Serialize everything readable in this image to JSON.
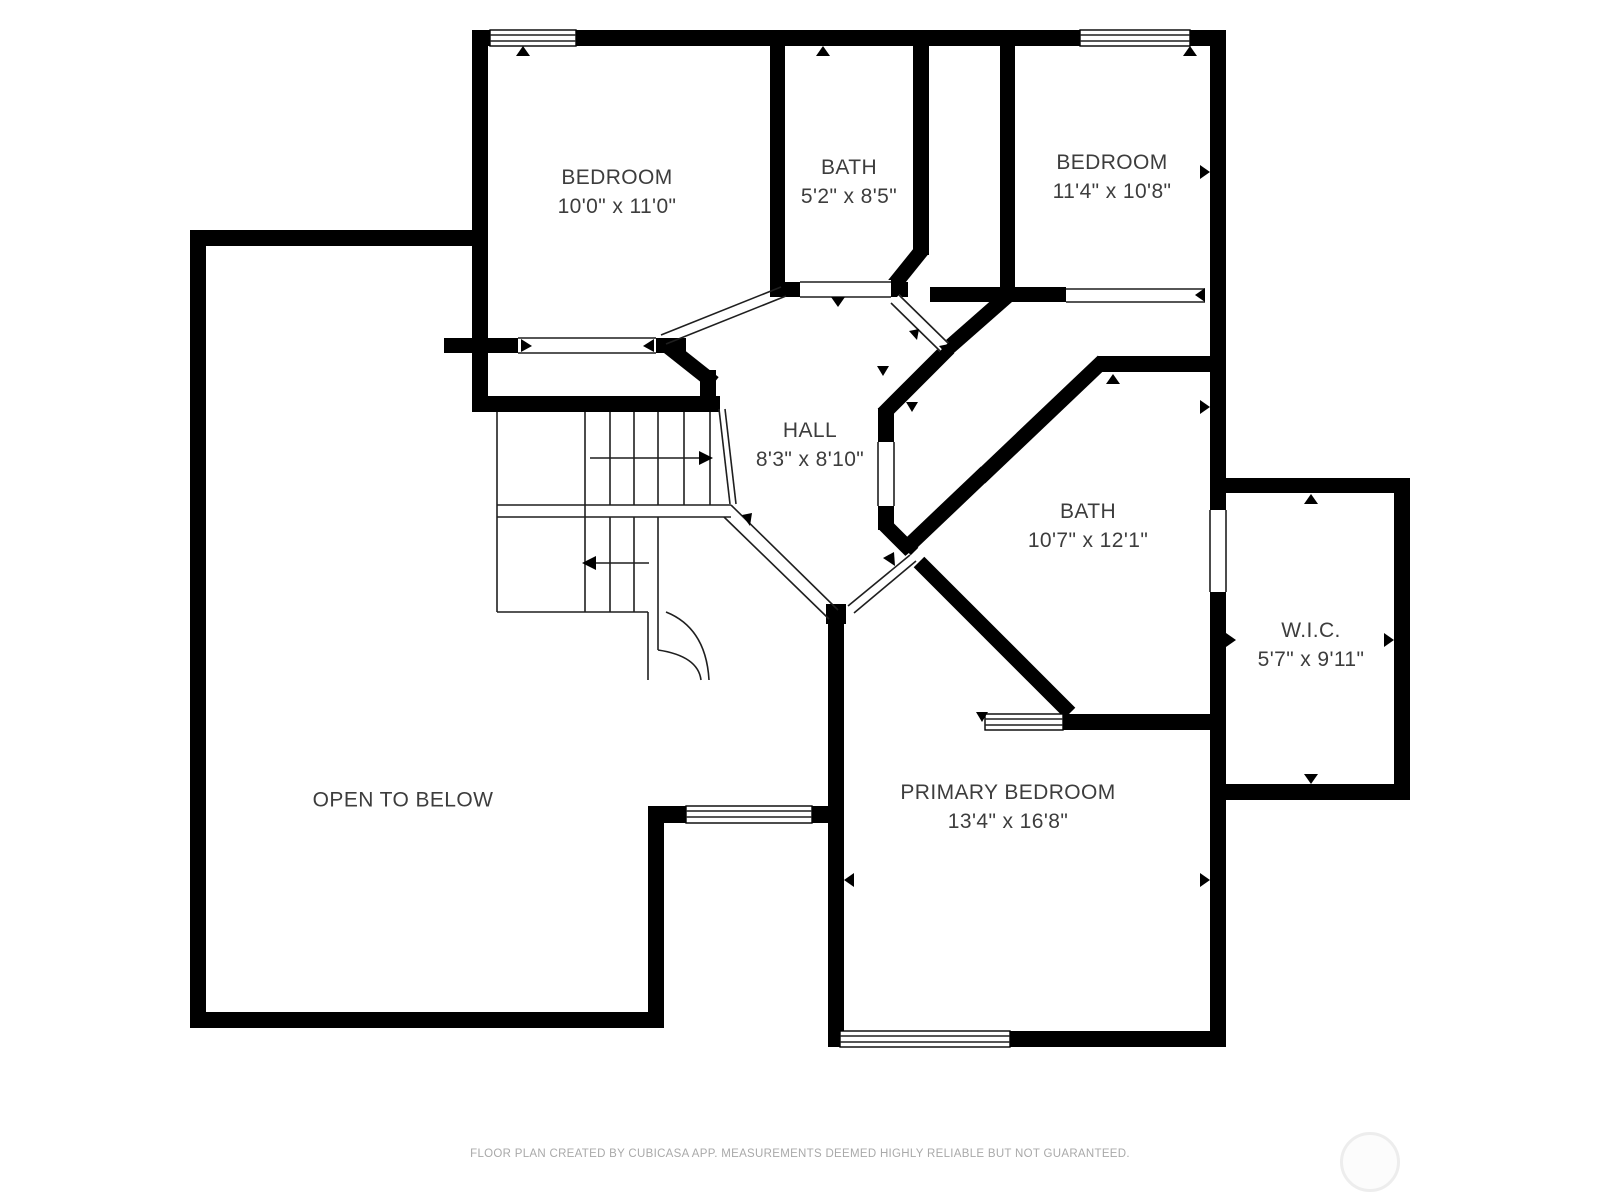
{
  "rooms": [
    {
      "id": "bedroom-top-left",
      "name": "BEDROOM",
      "dims": "10'0\" x 11'0\""
    },
    {
      "id": "bath-top",
      "name": "BATH",
      "dims": "5'2\" x 8'5\""
    },
    {
      "id": "bedroom-top-right",
      "name": "BEDROOM",
      "dims": "11'4\" x 10'8\""
    },
    {
      "id": "hall",
      "name": "HALL",
      "dims": "8'3\" x 8'10\""
    },
    {
      "id": "bath-main",
      "name": "BATH",
      "dims": "10'7\" x 12'1\""
    },
    {
      "id": "wic",
      "name": "W.I.C.",
      "dims": "5'7\" x 9'11\""
    },
    {
      "id": "primary-bedroom",
      "name": "PRIMARY BEDROOM",
      "dims": "13'4\" x 16'8\""
    },
    {
      "id": "open-to-below",
      "name": "OPEN TO BELOW",
      "dims": ""
    }
  ],
  "footer": {
    "text": "FLOOR PLAN CREATED BY CUBICASA APP. MEASUREMENTS DEEMED HIGHLY RELIABLE BUT NOT GUARANTEED."
  },
  "colors": {
    "wall": "#000000",
    "room_label": "#3d3d3d",
    "thin_line": "#1f1f1f",
    "footer_text": "#a9a9a9",
    "background": "#ffffff",
    "watermark_ring": "#ededed"
  }
}
